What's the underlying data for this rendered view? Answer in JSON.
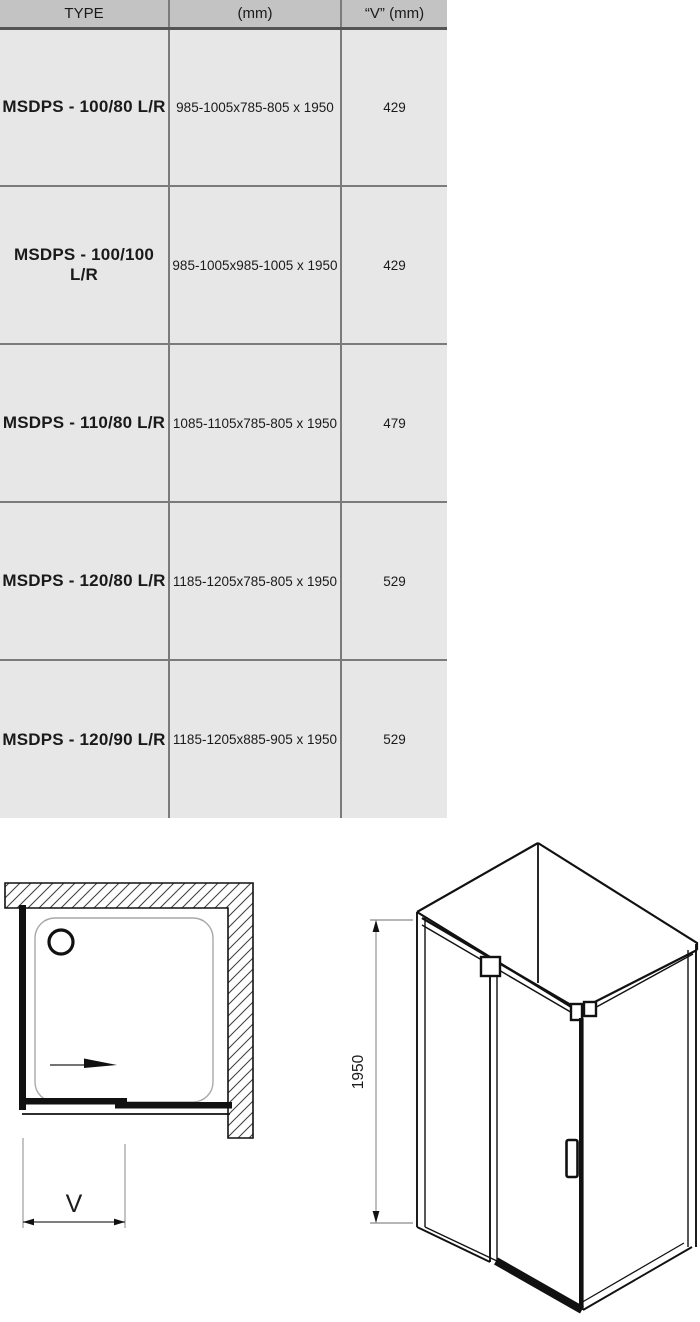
{
  "table": {
    "columns": [
      "TYPE",
      "(mm)",
      "“V”  (mm)"
    ],
    "rows": [
      {
        "type": "MSDPS - 100/80 L/R",
        "dimensions": "985-1005x785-805 x 1950",
        "v": "429"
      },
      {
        "type": "MSDPS - 100/100 L/R",
        "dimensions": "985-1005x985-1005 x 1950",
        "v": "429"
      },
      {
        "type": "MSDPS - 110/80 L/R",
        "dimensions": "1085-1105x785-805 x 1950",
        "v": "479"
      },
      {
        "type": "MSDPS - 120/80 L/R",
        "dimensions": "1185-1205x785-805 x 1950",
        "v": "529"
      },
      {
        "type": "MSDPS - 120/90 L/R",
        "dimensions": "1185-1205x885-905 x 1950",
        "v": "529"
      }
    ]
  },
  "diagrams": {
    "top_view": {
      "dimension_label": "V"
    },
    "iso_view": {
      "height_label": "1950"
    }
  },
  "colors": {
    "header_bg": "#c3c3c3",
    "row_bg": "#e7e7e7",
    "grid_line": "#7b7b7b",
    "drawing_line": "#111111",
    "dim_line": "#888888"
  }
}
